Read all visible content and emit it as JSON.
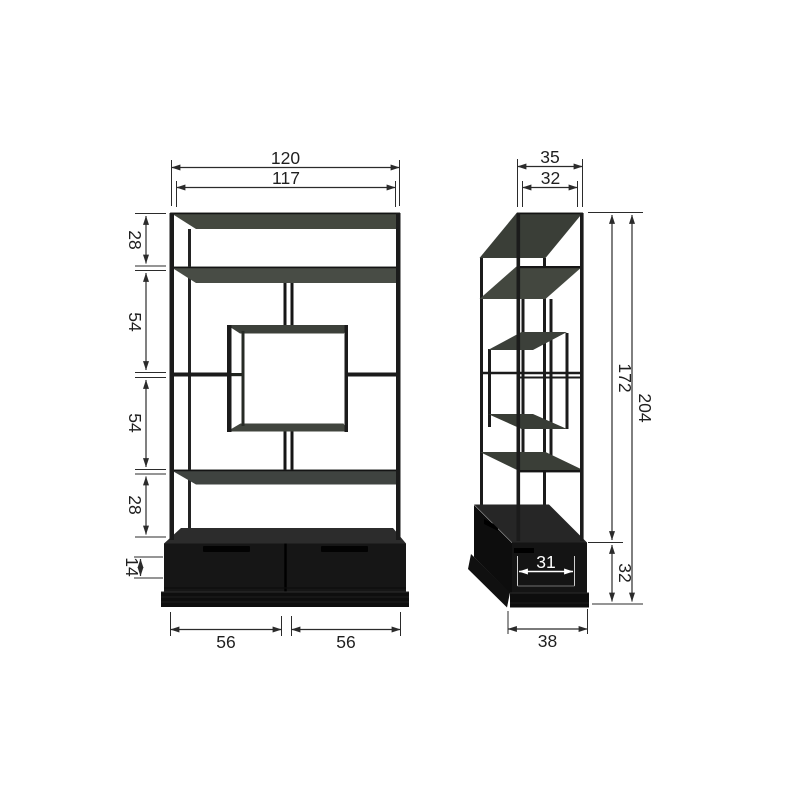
{
  "diagram": {
    "front_view": {
      "width_total": "120",
      "width_inner": "117",
      "section_heights": [
        "28",
        "54",
        "54",
        "28"
      ],
      "drawer_front_height": "14",
      "drawer_widths": [
        "56",
        "56"
      ]
    },
    "side_view": {
      "depth_total": "35",
      "depth_inner": "32",
      "frame_height": "172",
      "total_height": "204",
      "base_inner_depth": "31",
      "base_height": "32",
      "base_depth": "38"
    },
    "colors": {
      "background": "#ffffff",
      "dimension_line": "#2b2b2b",
      "structure": "#1b1b1b",
      "shelf_surface": "#474b44",
      "base_cabinet": "#161616",
      "inverse_text": "#ffffff"
    }
  }
}
